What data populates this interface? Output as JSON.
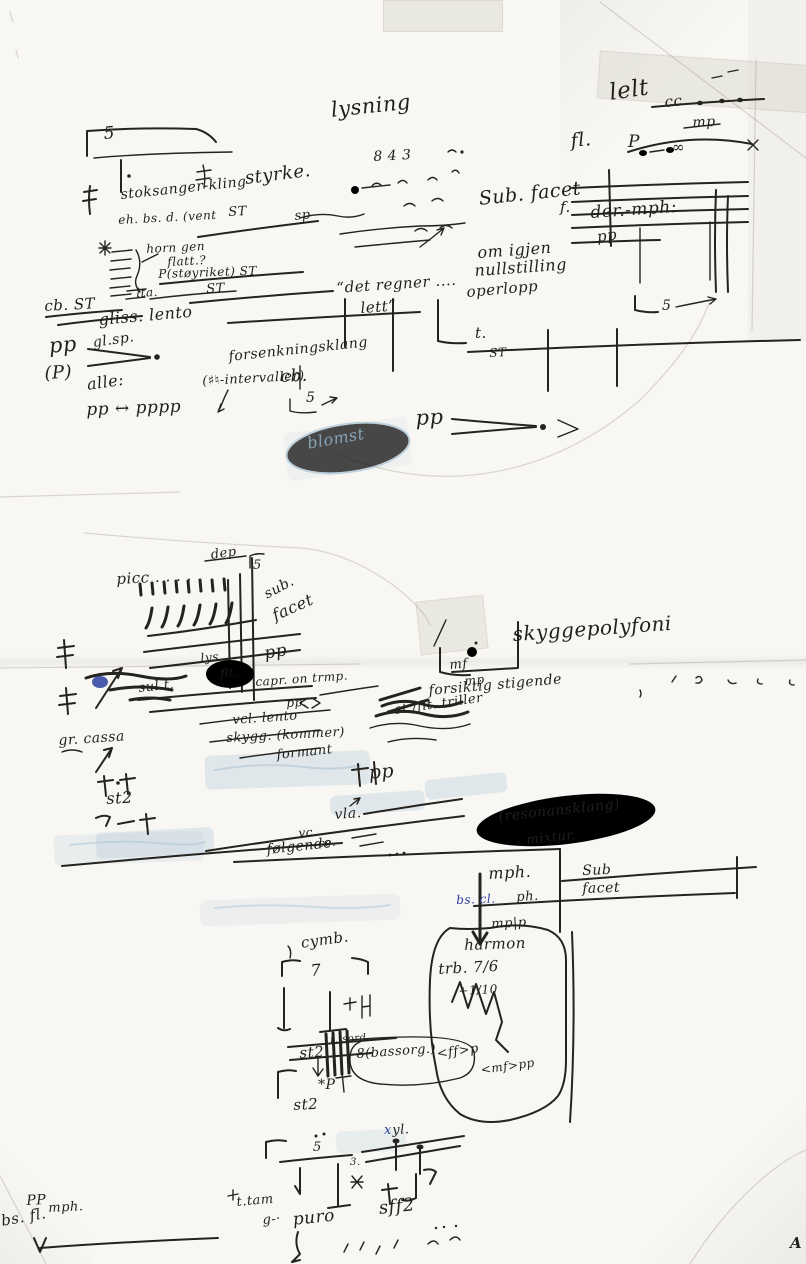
{
  "document": {
    "kind": "scanned handwritten music sketch page",
    "paper_color": "#f8f7f3",
    "ink_color": "#24231f",
    "blue_ink_color": "#2a3f9e",
    "faded_blue_color": "#93b3c9"
  },
  "annotations": [
    {
      "id": "five-top-left",
      "t": "5",
      "x": 103,
      "y": 126,
      "s": 17,
      "r": -5
    },
    {
      "id": "lysning",
      "t": "lysning",
      "x": 330,
      "y": 100,
      "s": 21,
      "r": -6
    },
    {
      "id": "lelt-top-right",
      "t": "lelt",
      "x": 608,
      "y": 82,
      "s": 23,
      "r": -8
    },
    {
      "id": "cc",
      "t": "cc",
      "x": 664,
      "y": 95,
      "s": 15,
      "r": -5
    },
    {
      "id": "mp-top-right",
      "t": "mp",
      "x": 692,
      "y": 116,
      "s": 14,
      "r": -3
    },
    {
      "id": "infinity",
      "t": "∞",
      "x": 672,
      "y": 140,
      "s": 15,
      "r": 0
    },
    {
      "id": "fl-top-right",
      "t": "fl.",
      "x": 570,
      "y": 132,
      "s": 19,
      "r": -5
    },
    {
      "id": "p-top-right",
      "t": "P",
      "x": 628,
      "y": 134,
      "s": 17,
      "r": 0
    },
    {
      "id": "styrke",
      "t": "styrke.",
      "x": 244,
      "y": 170,
      "s": 18,
      "r": -7
    },
    {
      "id": "numbers-843",
      "t": "8 4 3",
      "x": 373,
      "y": 150,
      "s": 14,
      "r": -3
    },
    {
      "id": "stoksanger-kling",
      "t": "stoksanger-kling",
      "x": 120,
      "y": 188,
      "s": 14,
      "r": -6
    },
    {
      "id": "eh-bs-d-vent",
      "t": "eh. bs. d. (vent",
      "x": 118,
      "y": 214,
      "s": 12,
      "r": -3
    },
    {
      "id": "st-1",
      "t": "ST",
      "x": 228,
      "y": 206,
      "s": 13,
      "r": -3
    },
    {
      "id": "sp-1",
      "t": "sp",
      "x": 294,
      "y": 210,
      "s": 13,
      "r": -6
    },
    {
      "id": "sub-facet-1",
      "t": "Sub. facet",
      "x": 478,
      "y": 190,
      "s": 19,
      "r": -6
    },
    {
      "id": "f-top-right",
      "t": "f.",
      "x": 560,
      "y": 200,
      "s": 15,
      "r": 0
    },
    {
      "id": "der-mph",
      "t": "der.-mph:",
      "x": 590,
      "y": 205,
      "s": 17,
      "r": -4
    },
    {
      "id": "pp-top-right",
      "t": "pp",
      "x": 596,
      "y": 230,
      "s": 15,
      "r": -8
    },
    {
      "id": "horn-gen",
      "t": "horn gen",
      "x": 146,
      "y": 243,
      "s": 12,
      "r": -3
    },
    {
      "id": "flatt",
      "t": "flatt.?",
      "x": 167,
      "y": 256,
      "s": 12,
      "r": -3
    },
    {
      "id": "p-stoyriket",
      "t": "P(støyriket) ST",
      "x": 158,
      "y": 268,
      "s": 12,
      "r": -2
    },
    {
      "id": "lta",
      "t": "lta.",
      "x": 136,
      "y": 287,
      "s": 12,
      "r": -3
    },
    {
      "id": "st-2",
      "t": "ST",
      "x": 206,
      "y": 283,
      "s": 13,
      "r": -3
    },
    {
      "id": "om-igjen",
      "t": "om igjen",
      "x": 477,
      "y": 245,
      "s": 16,
      "r": -4
    },
    {
      "id": "nullstilling",
      "t": "nullstilling",
      "x": 474,
      "y": 263,
      "s": 16,
      "r": -4
    },
    {
      "id": "operlopp",
      "t": "operlopp",
      "x": 466,
      "y": 285,
      "s": 15,
      "r": -5
    },
    {
      "id": "cb-st",
      "t": "cb. ST",
      "x": 44,
      "y": 299,
      "s": 15,
      "r": -3
    },
    {
      "id": "gliss-lento",
      "t": "gliss. lento",
      "x": 98,
      "y": 312,
      "s": 16,
      "r": -5
    },
    {
      "id": "gl-sp",
      "t": "gl.sp.",
      "x": 92,
      "y": 336,
      "s": 14,
      "r": -8
    },
    {
      "id": "det-regner",
      "t": "“det regner ....",
      "x": 336,
      "y": 281,
      "s": 15,
      "r": -4
    },
    {
      "id": "lett",
      "t": "lett”",
      "x": 360,
      "y": 301,
      "s": 15,
      "r": -4
    },
    {
      "id": "pp-left",
      "t": "pp",
      "x": 48,
      "y": 336,
      "s": 21,
      "r": -5
    },
    {
      "id": "p-paren",
      "t": "(P)",
      "x": 44,
      "y": 365,
      "s": 18,
      "r": -3
    },
    {
      "id": "alle",
      "t": "alle:",
      "x": 86,
      "y": 377,
      "s": 16,
      "r": -8
    },
    {
      "id": "pp-pppp",
      "t": "pp ↔ pppp",
      "x": 86,
      "y": 402,
      "s": 17,
      "r": -2
    },
    {
      "id": "forsenkningsklang",
      "t": "forsenkningsklang",
      "x": 228,
      "y": 350,
      "s": 14,
      "r": -6
    },
    {
      "id": "intervaller",
      "t": "(♯♮-intervaller)",
      "x": 202,
      "y": 375,
      "s": 13,
      "r": -3
    },
    {
      "id": "t-mid",
      "t": "t.",
      "x": 475,
      "y": 326,
      "s": 15,
      "r": 0
    },
    {
      "id": "st-3",
      "t": "ST",
      "x": 489,
      "y": 347,
      "s": 12,
      "r": -3
    },
    {
      "id": "cb-2",
      "t": "cb.",
      "x": 280,
      "y": 369,
      "s": 17,
      "r": -3
    },
    {
      "id": "five-mid",
      "t": "5",
      "x": 306,
      "y": 391,
      "s": 14,
      "r": 0
    },
    {
      "id": "pp-mid",
      "t": "pp",
      "x": 415,
      "y": 408,
      "s": 21,
      "r": -3
    },
    {
      "id": "blomst",
      "t": "blomst",
      "x": 306,
      "y": 436,
      "s": 16,
      "r": -10,
      "c": "faded"
    },
    {
      "id": "dep",
      "t": "dep",
      "x": 210,
      "y": 549,
      "s": 13,
      "r": -8
    },
    {
      "id": "picc",
      "t": "picc . . . .",
      "x": 116,
      "y": 572,
      "s": 15,
      "r": -3
    },
    {
      "id": "five-picc",
      "t": "5",
      "x": 253,
      "y": 559,
      "s": 13,
      "r": 0
    },
    {
      "id": "sub-diag",
      "t": "sub.",
      "x": 262,
      "y": 589,
      "s": 14,
      "r": -28
    },
    {
      "id": "facet-diag",
      "t": "facet",
      "x": 270,
      "y": 609,
      "s": 16,
      "r": -24
    },
    {
      "id": "pp-picc",
      "t": "pp",
      "x": 263,
      "y": 646,
      "s": 17,
      "r": -10
    },
    {
      "id": "lys",
      "t": "lys.",
      "x": 200,
      "y": 652,
      "s": 12,
      "r": -5
    },
    {
      "id": "flt-circled",
      "t": "flt.",
      "x": 220,
      "y": 668,
      "s": 11,
      "r": -3
    },
    {
      "id": "sul-t",
      "t": "sul t.",
      "x": 138,
      "y": 682,
      "s": 13,
      "r": -6
    },
    {
      "id": "capr-on-trmp",
      "t": "capr. on trmp.",
      "x": 255,
      "y": 676,
      "s": 12,
      "r": -4
    },
    {
      "id": "pp-dot",
      "t": "pp.",
      "x": 286,
      "y": 697,
      "s": 12,
      "r": -3
    },
    {
      "id": "vcl-lento",
      "t": "vcl. lento",
      "x": 232,
      "y": 714,
      "s": 13,
      "r": -4
    },
    {
      "id": "skygg-kommer",
      "t": "skygg. (kommer)",
      "x": 226,
      "y": 732,
      "s": 13,
      "r": -3
    },
    {
      "id": "formant",
      "t": "formant",
      "x": 276,
      "y": 749,
      "s": 13,
      "r": -6
    },
    {
      "id": "skyggepolyfoni",
      "t": "skyggepolyfoni",
      "x": 512,
      "y": 624,
      "s": 20,
      "r": -4
    },
    {
      "id": "mf-mid",
      "t": "mf",
      "x": 449,
      "y": 659,
      "s": 13,
      "r": -5
    },
    {
      "id": "mp-mid",
      "t": "mp",
      "x": 464,
      "y": 675,
      "s": 12,
      "r": -5
    },
    {
      "id": "forsiktig-stigende",
      "t": "forsiktig stigende",
      "x": 428,
      "y": 684,
      "s": 14,
      "r": -5
    },
    {
      "id": "st-flt-triller",
      "t": "st./flt. triller",
      "x": 394,
      "y": 704,
      "s": 13,
      "r": -8
    },
    {
      "id": "gr-cassa",
      "t": "gr. cassa",
      "x": 58,
      "y": 734,
      "s": 14,
      "r": -4
    },
    {
      "id": "st2-1",
      "t": "st2",
      "x": 106,
      "y": 791,
      "s": 16,
      "r": -3
    },
    {
      "id": "pp-mid2",
      "t": "pp",
      "x": 368,
      "y": 764,
      "s": 19,
      "r": -5
    },
    {
      "id": "vla",
      "t": "vla.",
      "x": 334,
      "y": 808,
      "s": 14,
      "r": -4
    },
    {
      "id": "vc",
      "t": "vc",
      "x": 298,
      "y": 827,
      "s": 12,
      "r": -4
    },
    {
      "id": "ce",
      "t": "ce.",
      "x": 318,
      "y": 838,
      "s": 11,
      "r": -4
    },
    {
      "id": "folgende",
      "t": "følgende",
      "x": 266,
      "y": 843,
      "s": 14,
      "r": -6
    },
    {
      "id": "resonansklang",
      "t": "(resonansklang)",
      "x": 498,
      "y": 810,
      "s": 14,
      "r": -6
    },
    {
      "id": "mixtur",
      "t": "mixtur.",
      "x": 526,
      "y": 834,
      "s": 13,
      "r": -6
    },
    {
      "id": "mph",
      "t": "mph.",
      "x": 488,
      "y": 866,
      "s": 16,
      "r": -3
    },
    {
      "id": "bs-cl",
      "t": "bs. cl.",
      "x": 456,
      "y": 894,
      "s": 12,
      "r": -2,
      "c": "blue"
    },
    {
      "id": "ph",
      "t": "ph.",
      "x": 516,
      "y": 891,
      "s": 13,
      "r": -3
    },
    {
      "id": "sub-2",
      "t": "Sub",
      "x": 582,
      "y": 864,
      "s": 14,
      "r": -2
    },
    {
      "id": "facet-2",
      "t": "facet",
      "x": 582,
      "y": 882,
      "s": 14,
      "r": -2
    },
    {
      "id": "mp-p",
      "t": "mp|p",
      "x": 491,
      "y": 918,
      "s": 13,
      "r": -3
    },
    {
      "id": "harmon",
      "t": "harmon",
      "x": 464,
      "y": 938,
      "s": 15,
      "r": -2
    },
    {
      "id": "trb-76",
      "t": "trb. 7/6",
      "x": 438,
      "y": 962,
      "s": 15,
      "r": -3
    },
    {
      "id": "plus-110",
      "t": "+1/10",
      "x": 458,
      "y": 985,
      "s": 12,
      "r": -3
    },
    {
      "id": "ff-p",
      "t": "<ff>p",
      "x": 436,
      "y": 1048,
      "s": 13,
      "r": -8
    },
    {
      "id": "mf-pp",
      "t": "<mf>pp",
      "x": 480,
      "y": 1064,
      "s": 12,
      "r": -8
    },
    {
      "id": "cymb",
      "t": "cymb.",
      "x": 300,
      "y": 936,
      "s": 15,
      "r": -8
    },
    {
      "id": "seven",
      "t": "7",
      "x": 310,
      "y": 963,
      "s": 16,
      "r": -5
    },
    {
      "id": "t-sord",
      "t": "t. sord.",
      "x": 330,
      "y": 1036,
      "s": 10,
      "r": -4
    },
    {
      "id": "st2-2",
      "t": "st2",
      "x": 299,
      "y": 1046,
      "s": 15,
      "r": -3
    },
    {
      "id": "bassorg",
      "t": "8(bassorg.)",
      "x": 356,
      "y": 1048,
      "s": 13,
      "r": -4
    },
    {
      "id": "star-p",
      "t": "*P",
      "x": 318,
      "y": 1078,
      "s": 14,
      "r": 0
    },
    {
      "id": "st2-3",
      "t": "st2",
      "x": 293,
      "y": 1098,
      "s": 15,
      "r": -3
    },
    {
      "id": "xyl-x",
      "t": "x",
      "x": 384,
      "y": 1124,
      "s": 13,
      "r": 0,
      "c": "blue"
    },
    {
      "id": "xyl-yl",
      "t": "yl.",
      "x": 392,
      "y": 1124,
      "s": 13,
      "r": -3
    },
    {
      "id": "five-bottom",
      "t": "5",
      "x": 313,
      "y": 1141,
      "s": 13,
      "r": 0
    },
    {
      "id": "three-bottom",
      "t": "3.",
      "x": 350,
      "y": 1158,
      "s": 10,
      "r": 0
    },
    {
      "id": "t-tam",
      "t": "t.tam",
      "x": 236,
      "y": 1196,
      "s": 13,
      "r": -5
    },
    {
      "id": "g-dash",
      "t": "g-·",
      "x": 262,
      "y": 1214,
      "s": 13,
      "r": -5
    },
    {
      "id": "puro",
      "t": "puro",
      "x": 292,
      "y": 1212,
      "s": 17,
      "r": -6
    },
    {
      "id": "sff2",
      "t": "sff2",
      "x": 378,
      "y": 1200,
      "s": 18,
      "r": -6
    },
    {
      "id": "bs-fl-bottom",
      "t": "bs. fl.",
      "x": 0,
      "y": 1214,
      "s": 15,
      "r": -10
    },
    {
      "id": "pp-bottom-left",
      "t": "PP",
      "x": 26,
      "y": 1194,
      "s": 14,
      "r": -3
    },
    {
      "id": "mph-bottom-left",
      "t": "mph.",
      "x": 48,
      "y": 1202,
      "s": 13,
      "r": -3
    },
    {
      "id": "corner-mark",
      "t": "A",
      "x": 790,
      "y": 1236,
      "s": 15,
      "r": 0,
      "w": "b"
    }
  ]
}
